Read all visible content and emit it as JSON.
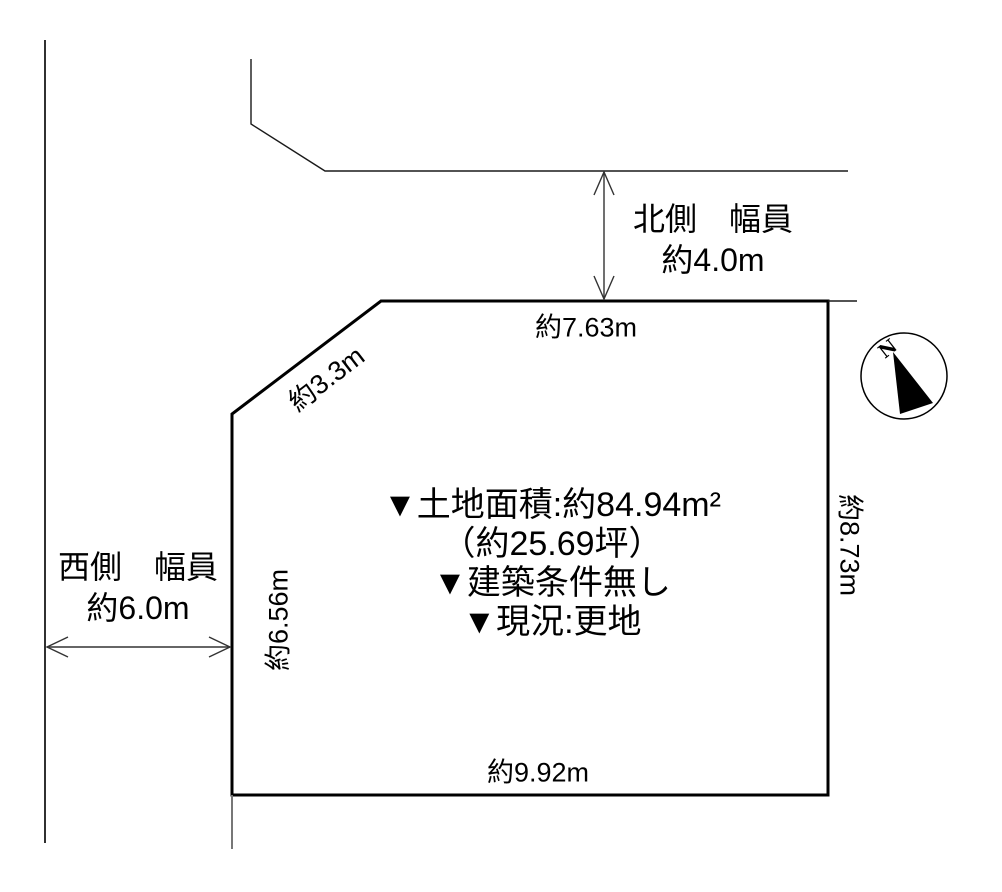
{
  "diagram": {
    "type": "land-plot-survey",
    "background_color": "#ffffff",
    "line_color": "#000000",
    "north_road": {
      "line1": "北側　幅員",
      "line2": "約4.0m"
    },
    "west_road": {
      "line1": "西側　幅員",
      "line2": "約6.0m"
    },
    "dimensions": {
      "top": "約7.63m",
      "diagonal": "約3.3m",
      "left": "約6.56m",
      "right": "約8.73m",
      "bottom": "約9.92m"
    },
    "info": {
      "line1": "▼土地面積:約84.94m²",
      "line2": "（約25.69坪）",
      "line3": "▼建築条件無し",
      "line4": "▼現況:更地"
    },
    "compass": {
      "label": "N"
    }
  }
}
